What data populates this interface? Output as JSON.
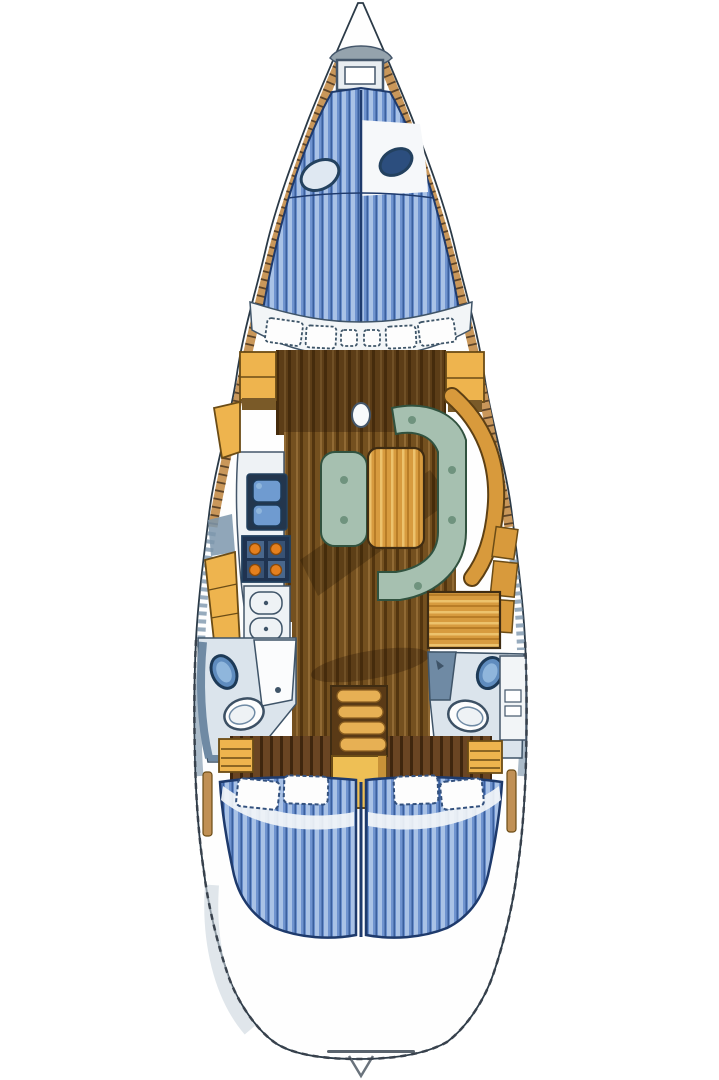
{
  "figure": {
    "kind": "sailboat-interior-deck-plan",
    "orientation": "bow-up"
  },
  "areas": {
    "bow": "anchor-locker",
    "forward_cabin": "v-berth-double",
    "forward_bench": "curved-seat-lockers",
    "salon": "u-settee-with-table",
    "galley": "port-galley-sink-stove-fridge",
    "nav_station": "chart-table",
    "head_port": "port-bathroom",
    "head_starboard": "starboard-bathroom",
    "companionway": "steps",
    "engine": "engine-box",
    "aft_cabin_port": "double-berth",
    "aft_cabin_starboard": "double-berth",
    "stern": "transom"
  },
  "palette": {
    "page_bg": "#ffffff",
    "hull_fill": "#fefefe",
    "hull_line": "#2b3a47",
    "outline_dash": "#39424d",
    "deck_wood": "#c9975a",
    "deck_tick": "#4a3520",
    "hull_band_grey": "#7d96ad",
    "anchor_locker": "#95a3ad",
    "berth_blue": "#6f93cf",
    "berth_stripe_light": "#a9c2e6",
    "berth_stripe_dark": "#3a5f9e",
    "berth_outline": "#1e3a6c",
    "hatch_fill": "#e8edf1",
    "white_patch": "#f6f8fa",
    "porthole_ring": "#23415f",
    "porthole_dark": "#2c4e7e",
    "bench_white": "#f2f5f7",
    "cushion_white": "#fdfdfd",
    "cushion_edge": "#3e5568",
    "locker_yellow": "#eeb44e",
    "locker_outline": "#6b4c16",
    "locker_base": "#7a5a28",
    "floor_base": "#74501f",
    "floor_dark": "#53350f",
    "floor_light": "#916a34",
    "shadow_dark": "#241505",
    "table_amber": "#d79b3f",
    "table_line": "#b87d28",
    "table_light": "#ecc26d",
    "wood_outline": "#3f2c12",
    "settee_green": "#a6c0b0",
    "settee_spot": "#6f937e",
    "settee_outline": "#31523f",
    "backrest_amber": "#d89a3c",
    "backrest_edge": "#5d4014",
    "counter_white": "#eef2f5",
    "counter_edge": "#44566a",
    "sink_frame": "#23364d",
    "sink_basin": "#6f9bd0",
    "sink_basin_light": "#8fb6dc",
    "stove_frame": "#1f3350",
    "stove_check": "#49678c",
    "burner_orange": "#e5801e",
    "burner_edge": "#8a4a0a",
    "head_wall": "#dbe4ec",
    "head_edge": "#3f5468",
    "head_band": "#6f8aa4",
    "door_white": "#fbfcfd",
    "fixture_blue": "#5f8cbe",
    "fixture_ring": "#1d3a57",
    "toilet_white": "#fdfdfd",
    "toilet_edge": "#3c5064",
    "toilet_inner": "#eef2f5",
    "steps_amber": "#e7b054",
    "steps_edge": "#8a5e20",
    "steps_frame": "#5a3a16",
    "engine_yellow": "#eebf55",
    "engine_shade": "#c89238",
    "slat_wood": "#6a4523",
    "slat_dark": "#3f260e",
    "pillow_edge": "#33517e",
    "sheet_white": "#f2f5f8",
    "post_wood": "#c09055",
    "stern_shade": "#ccd5dd",
    "transom_grey": "#5a646e",
    "notch_grey": "#6a737c"
  }
}
